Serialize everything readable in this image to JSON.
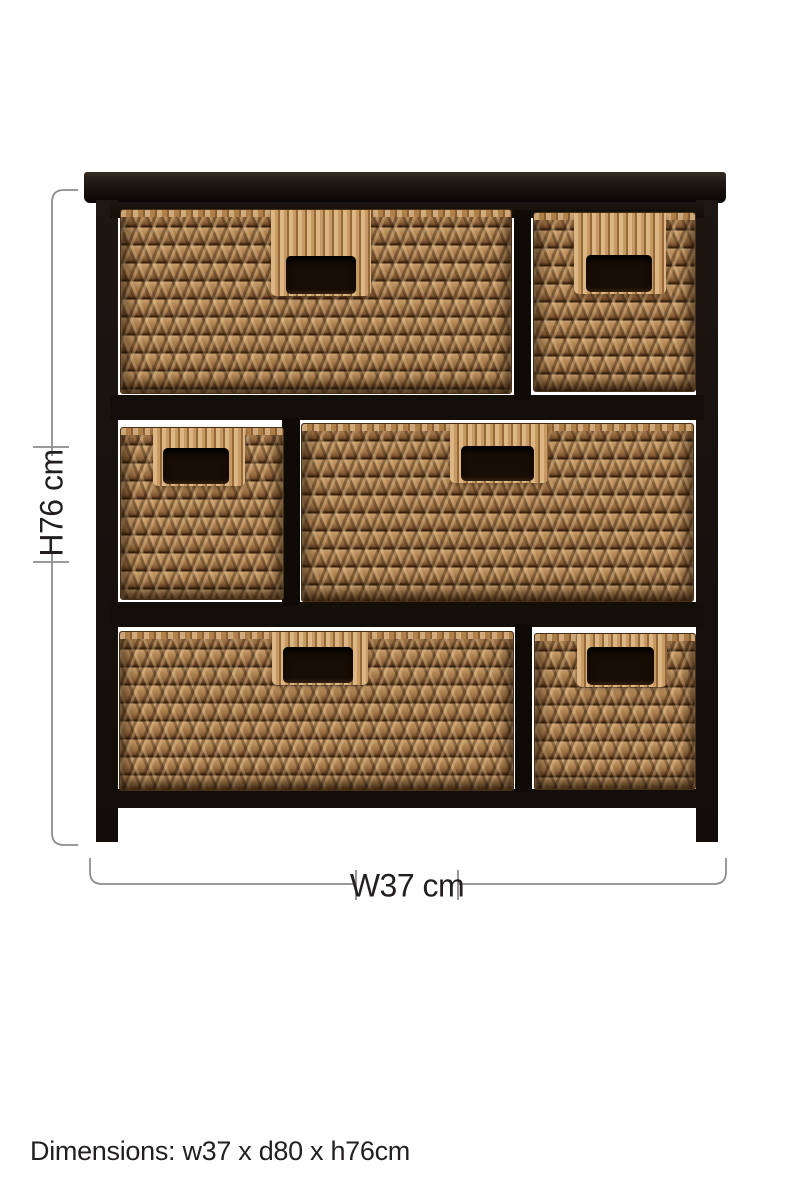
{
  "figure": {
    "type": "product-dimension-diagram",
    "subject": "black-frame storage chest with six woven wicker basket drawers",
    "basket_count": 6,
    "rows": 3
  },
  "annotations": {
    "height_label": "H76 cm",
    "width_label": "W37 cm",
    "footer_text": "Dimensions: w37 x d80 x h76cm"
  },
  "colors": {
    "background": "#ffffff",
    "frame": "#17110d",
    "basket_base": "#a87e50",
    "basket_light": "#cba378",
    "basket_dark": "#3a2310",
    "dimension_line": "#8c8c8c",
    "label_text": "#231f20"
  }
}
